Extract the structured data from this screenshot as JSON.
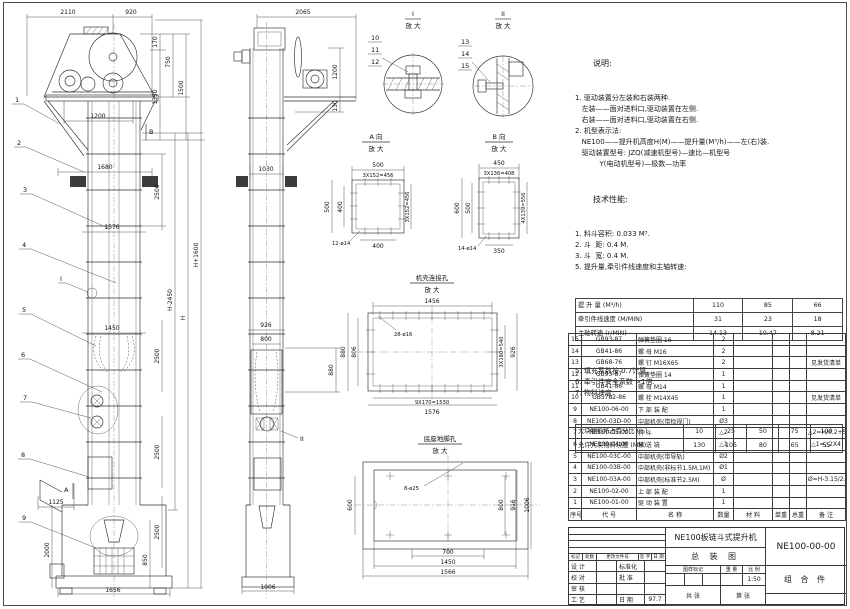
{
  "labels": {
    "magnify": "放 大",
    "detail1": "I",
    "detail2": "II",
    "viewA": "A 向",
    "viewB": "B 向",
    "shell_title": "机壳连接孔",
    "base_title": "底座地脚孔",
    "marker_A": "A",
    "marker_B": "B",
    "marker_I": "I",
    "marker_II": "II"
  },
  "balloons": [
    "1",
    "2",
    "3",
    "4",
    "5",
    "6",
    "7",
    "8",
    "9",
    "10",
    "11",
    "12",
    "13",
    "14",
    "15"
  ],
  "dims": {
    "front": {
      "d2110": "2110",
      "d920": "920",
      "d170": "170",
      "d750": "750",
      "d1350": "1350",
      "d1500": "1500",
      "d1200": "1200",
      "d1680": "1680",
      "d2500": "2500",
      "d1576": "1576",
      "dHp": "H+1600",
      "dHm": "H-2450",
      "dH": "H",
      "d1450": "1450",
      "d1125": "1125",
      "d2000": "2000",
      "d850": "850",
      "d1656": "1656"
    },
    "side": {
      "d2065": "2065",
      "d1200": "1200",
      "d130": "130",
      "d1030": "1030",
      "d926": "926",
      "d800": "800",
      "d880": "880",
      "d1006": "1006"
    },
    "viewA": {
      "d500": "500",
      "dpitch": "3X152=456",
      "d400": "400",
      "dholes": "12-ø14"
    },
    "viewB": {
      "d450": "450",
      "dpitch": "3X136=408",
      "d600": "600",
      "d500": "500",
      "dpitchv": "4X139=556",
      "d350": "350",
      "dholes": "14-ø14"
    },
    "shell": {
      "d1456": "1456",
      "dholes": "28-ø16",
      "d880": "880",
      "d806": "806",
      "dpitch": "3X180=540",
      "d926": "926",
      "dbottom": "9X170=1530",
      "d1576": "1576"
    },
    "base": {
      "d600": "600",
      "dholes": "8-ø25",
      "d800": "800",
      "d916": "916",
      "d1006": "1006",
      "d700": "700",
      "d1450": "1450",
      "d1566": "1566"
    }
  },
  "notes": {
    "heading": "说明:",
    "lines": [
      "1. 驱动装置分左装和右装两种.",
      "   左装——面对进料口,驱动装置在左侧.",
      "   右装——面对进料口,驱动装置在右侧.",
      "2. 机型表示法:",
      "   NE100——提升机高度H(M)——提升量(M³/h)——左(右)装.",
      "   驱动装置型号: JZQ(减速机型号)—速比—机型号",
      "           Y(电动机型号)—极数—功率"
    ]
  },
  "tech": {
    "heading": "技术性能:",
    "lines_before": [
      "1. 料斗容积: 0.033 M³.",
      "2. 斗  距: 0.4 M.",
      "3. 斗  宽: 0.4 M.",
      "5. 提升量,牵引件线速度和主轴转速:"
    ],
    "table1": [
      [
        "提 升 量  (M³/h)",
        "110",
        "85",
        "66"
      ],
      [
        "牵引件线速度 (M/MIN)",
        "31",
        "23",
        "18"
      ],
      [
        "主轴转速 (r/MIN)",
        "14.13",
        "10.47",
        "8.21"
      ]
    ],
    "lines_after": [
      "5. 填充系数按 0.7计算.",
      "6. 牵引件安全系数 >1倍.",
      "7. 物料块度:"
    ],
    "table2": [
      [
        "大块物料所占百分比 (%)",
        "10",
        "25",
        "50",
        "75",
        "100"
      ],
      [
        "允许大块物料块度 (MM)",
        "130",
        "105",
        "80",
        "65",
        "55"
      ]
    ]
  },
  "bom": {
    "headers": [
      "序号",
      "代  号",
      "名  称",
      "数量",
      "材  料",
      "单重",
      "总重",
      "备  注"
    ],
    "rows": [
      [
        "15",
        "GB93-87",
        "弹簧垫圈 16",
        "2",
        "",
        "",
        "",
        ""
      ],
      [
        "14",
        "GB41-86",
        "螺 母 M16",
        "2",
        "",
        "",
        "",
        ""
      ],
      [
        "13",
        "GB68-76",
        "螺 钉 M16X65",
        "2",
        "",
        "",
        "",
        "见发货清单"
      ],
      [
        "12",
        "GB93-87",
        "弹簧垫圈 14",
        "1",
        "",
        "",
        "",
        ""
      ],
      [
        "11",
        "GB41-86",
        "螺 母 M14",
        "1",
        "",
        "",
        "",
        ""
      ],
      [
        "10",
        "GB5782-86",
        "螺 栓 M14X45",
        "1",
        "",
        "",
        "",
        "见发货清单"
      ],
      [
        "9",
        "NE100-06-00",
        "下 部 装 配",
        "1",
        "",
        "",
        "",
        ""
      ],
      [
        "8",
        "NE100-03D-00",
        "中部机壳(带检视门)",
        "Ø3",
        "",
        "",
        "",
        ""
      ],
      [
        "7",
        "NE100-05-00",
        "料 斗",
        "△2",
        "",
        "",
        "",
        "△2=H/0.2+5.75"
      ],
      [
        "6",
        "NE100-04-00",
        "输 送 链",
        "△1",
        "",
        "",
        "",
        "△1=△2X4"
      ],
      [
        "5",
        "NE100-03C-00",
        "中部机壳(带导轨)",
        "Ø2",
        "",
        "",
        "",
        ""
      ],
      [
        "4",
        "NE100-03B-00",
        "中部机壳(非标节1.5M,1M)",
        "Ø1",
        "",
        "",
        "",
        ""
      ],
      [
        "3",
        "NE100-03A-00",
        "中部机壳(标准节2.5M)",
        "Ø",
        "",
        "",
        "",
        "Ø=H-3.15/2.5"
      ],
      [
        "2",
        "NE100-02-00",
        "上 部 装 配",
        "1",
        "",
        "",
        "",
        ""
      ],
      [
        "1",
        "NE100-01-00",
        "驱 动 装 置",
        "1",
        "",
        "",
        "",
        ""
      ]
    ]
  },
  "titleblock": {
    "product": "NE100板链斗式提升机",
    "sheet_name": "总 装 图",
    "drawing_no": "NE100-00-00",
    "part_kind": "组 合 件",
    "rev_labels": [
      "标记",
      "处数",
      "更改文件号",
      "签 字",
      "日 期"
    ],
    "roles": [
      {
        "l": "设 计",
        "m": "标准化",
        "v": ""
      },
      {
        "l": "校 对",
        "m": "批 准",
        "v": ""
      },
      {
        "l": "审 核",
        "m": "",
        "v": ""
      },
      {
        "l": "工 艺",
        "m": "日 期",
        "v": "97.7"
      }
    ],
    "mark_label": "图样标记",
    "weight_label": "重 量",
    "scale_label": "比 例",
    "scale": "1:50",
    "sheets": "共  张",
    "page": "第  张"
  }
}
